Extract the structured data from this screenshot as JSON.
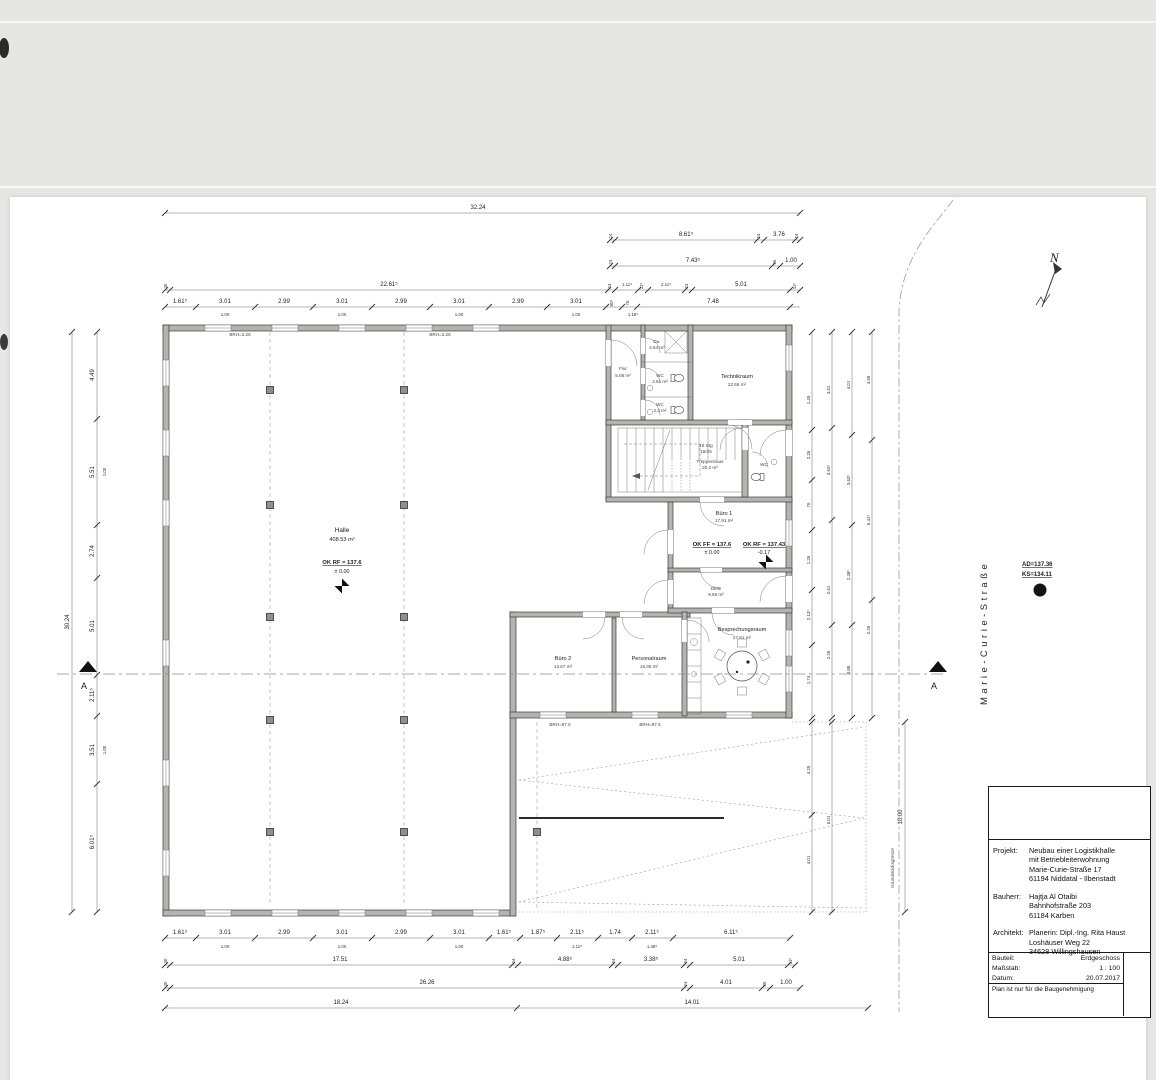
{
  "sheet": {
    "street": "Marie-Curie-Straße",
    "north_letter": "N",
    "section_letter": "A",
    "boundary_label": "Grundstücksgrenze",
    "manhole_line1": "AD=137.36",
    "manhole_line2": "KS=134.11"
  },
  "rooms": {
    "halle": {
      "name": "Halle",
      "area": "408.53 m²"
    },
    "flur": {
      "name": "Flur",
      "area": "5.06 m²"
    },
    "du": {
      "name": "Du.",
      "area": "2.64 m²"
    },
    "wc1": {
      "name": "WC",
      "area": "2.81 m²"
    },
    "wc2": {
      "name": "WC",
      "area": "2.2 m²"
    },
    "wc3": {
      "name": "WC",
      "area": "1.7 m²"
    },
    "technikraum": {
      "name": "Technikraum",
      "area": "22.55 m²"
    },
    "treppenhaus": {
      "name": "Treppenhaus",
      "area": "20.2 m²"
    },
    "buero1": {
      "name": "Büro 1",
      "area": "17.91 m²"
    },
    "diele": {
      "name": "Diele",
      "area": "9.66 m²"
    },
    "buero2": {
      "name": "Büro 2",
      "area": "13.67 m²"
    },
    "personalraum": {
      "name": "Personalraum",
      "area": "16.36 m²"
    },
    "besprechungsraum": {
      "name": "Besprechungsraum",
      "area": "27.61 m²"
    }
  },
  "levels": {
    "halle1": "OK RF = 137.6",
    "halle2": "± 0.00",
    "ff1": "OK FF = 137.6",
    "ff2": "± 0.00",
    "rf1": "OK RF = 137.43",
    "rf2": "-0.17"
  },
  "stairs": {
    "l1": "18 Stg",
    "l2": "18/25"
  },
  "notes": {
    "brh_top": "BRH=2.26",
    "brh_bottom": "BRH=87.5"
  },
  "dims": {
    "top": {
      "overall": "32.24",
      "row2": [
        "24",
        "8.61⁵",
        "24",
        "3.76",
        "24"
      ],
      "row3": [
        "24",
        "7.43⁵",
        "36",
        "1.00"
      ],
      "row4": [
        "30",
        "22.61⁵",
        "24",
        "1.11⁵",
        "11⁵",
        "2.11⁵",
        "24",
        "5.01",
        "11⁵"
      ],
      "row5": [
        "1.61⁵",
        "3.01",
        "2.99",
        "3.01",
        "2.99",
        "3.01",
        "2.99",
        "3.01",
        "80⁵",
        "76",
        "7.48"
      ],
      "row5_sub": [
        "1.00",
        "1.00",
        "1.00",
        "1.00",
        "1.18⁵"
      ]
    },
    "bottom": {
      "row1": [
        "1.61⁵",
        "3.01",
        "2.99",
        "3.01",
        "2.99",
        "3.01",
        "1.61⁵",
        "1.87⁵",
        "2.11⁵",
        "1.74",
        "2.11⁵",
        "6.11⁵"
      ],
      "row1_sub": [
        "1.00",
        "1.00",
        "1.00",
        "1.11⁵",
        "1.38⁵"
      ],
      "row2": [
        "30",
        "17.51",
        "24",
        "4.88⁵",
        "24",
        "3.38⁵",
        "24",
        "5.01",
        "11⁵"
      ],
      "row3": [
        "30",
        "26.26",
        "24",
        "4.01",
        "36",
        "1.00"
      ],
      "row4": [
        "18.24",
        "14.01"
      ]
    },
    "left": {
      "overall": "30.24",
      "chain": [
        "4.49",
        "5.51",
        "2.74",
        "5.01",
        "2.11⁵",
        "3.51",
        "6.01⁵"
      ],
      "sub": [
        "1.00",
        "1.00"
      ]
    },
    "right": {
      "c1": [
        "1.49",
        "2.26",
        "76",
        "1.26",
        "2.13⁵",
        "1.74"
      ],
      "c2": [
        "4.51",
        "3.63⁵",
        "2.51",
        "2.26"
      ],
      "c3": [
        "4.01",
        "3.63⁵",
        "2.38⁵",
        "4.88"
      ],
      "c4": [
        "4.99",
        "5.41⁵",
        "2.26"
      ],
      "lower": [
        "4.25",
        "4.01",
        "6.01",
        "10.00"
      ]
    }
  },
  "title_block": {
    "projekt_label": "Projekt:",
    "projekt": [
      "Neubau einer Logistikhalle",
      "mit Betriebleiterwohnung",
      "Marie-Curie-Straße 17",
      "61194 Niddatal - Ilbenstadt"
    ],
    "bauherr_label": "Bauherr:",
    "bauherr": [
      "Hajtja Al Otaibi",
      "Bahnhofstraße 203",
      "61184 Karben"
    ],
    "architekt_label": "Architekt:",
    "architekt": [
      "Planerin: Dipl.-Ing. Rita Haust",
      "Loshäuser Weg 22",
      "34628 Willingshausen"
    ],
    "bauteil_label": "Bauteil:",
    "bauteil": "Erdgeschoss",
    "massstab_label": "Maßstab:",
    "massstab": "1 : 100",
    "datum_label": "Datum:",
    "datum": "20.07.2017",
    "note": "Plan ist nur für die Baugenehmigung"
  }
}
